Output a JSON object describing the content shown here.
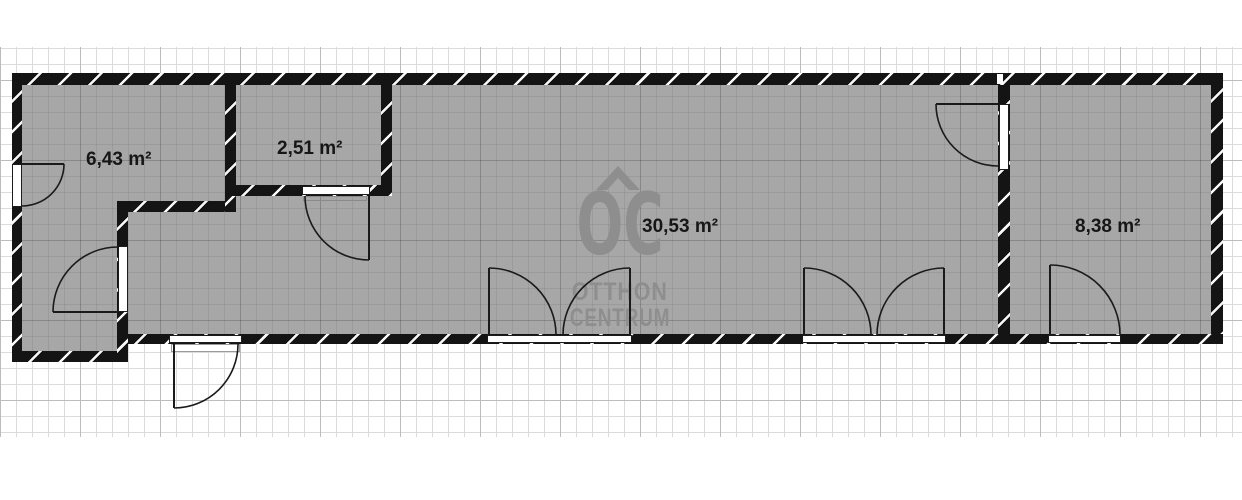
{
  "plan": {
    "type_label": "floor-plan",
    "rooms": [
      {
        "area_label": "6,43 m²"
      },
      {
        "area_label": "2,51 m²"
      },
      {
        "area_label": "30,53 m²"
      },
      {
        "area_label": "8,38 m²"
      }
    ],
    "watermark": {
      "logo": "OC",
      "line1": "OTTHON",
      "line2": "CENTRUM",
      "color": "#8e8e8e"
    },
    "colors": {
      "wall": "#141414",
      "wall_hatch": "#f8f8f8",
      "room_fill": "#a7a7a7",
      "grid_light": "#dbdbdb",
      "grid_heavy": "#bcbcbc",
      "label_text": "#161616",
      "opening": "#ffffff"
    }
  }
}
